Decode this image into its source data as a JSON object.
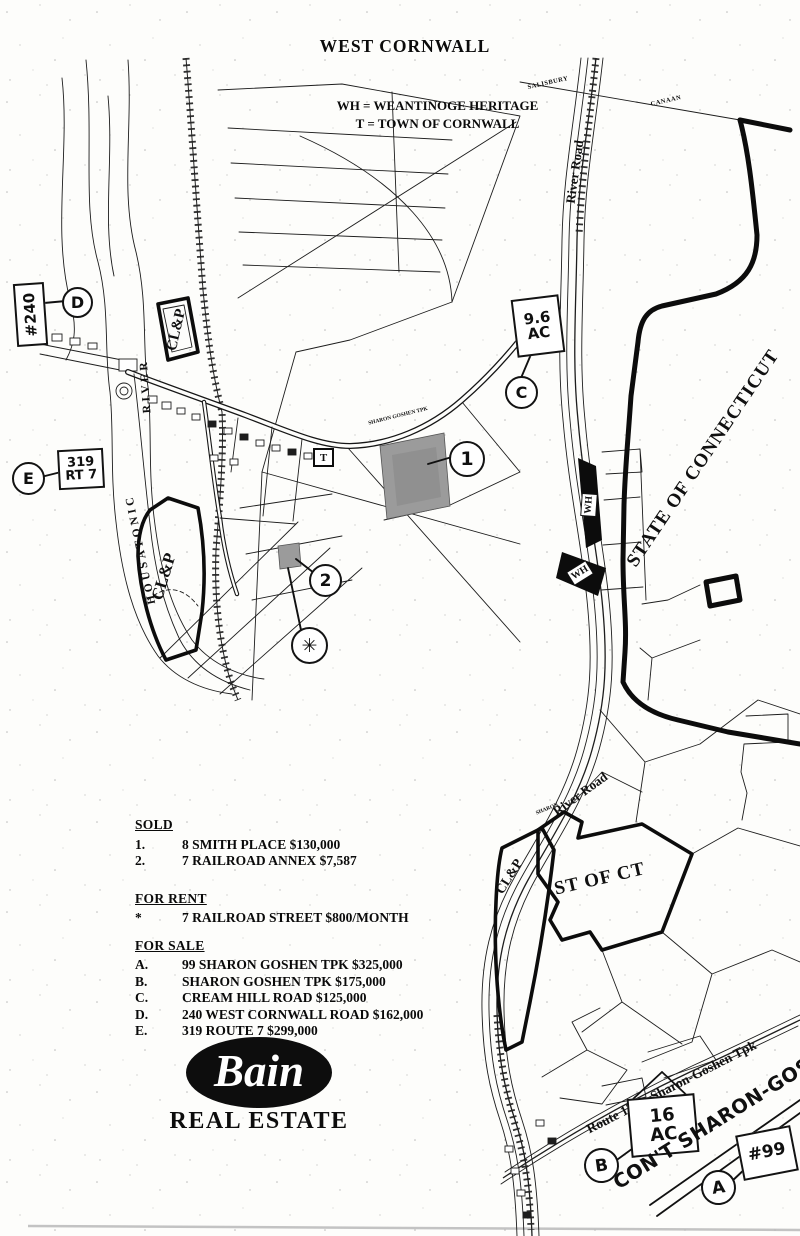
{
  "page": {
    "title": "WEST CORNWALL"
  },
  "legend": {
    "wh": "WH = WEANTINOGE HERITAGE",
    "t": "T = TOWN OF CORNWALL"
  },
  "map": {
    "towns": {
      "salisbury": "SALISBURY",
      "canaan": "CANAAN"
    },
    "roads": {
      "river_road_upper": "River Road",
      "river_road_lower": "River Road",
      "sharon_small": "SHARON",
      "route_120": "Route 120 – Sharon-Goshen Tpk",
      "sharon_goshen_tpk_small": "SHARON GOSHEN TPK"
    },
    "water": {
      "housatonic": "HOUSATONIC",
      "river": "RIVER"
    },
    "parcels": {
      "state_of_connecticut": "STATE OF CONNECTICUT",
      "st_of_ct": "ST OF CT",
      "clp_upper": "CL&P",
      "clp_lower": "CL&P",
      "clp_right": "CL&P",
      "wh_1": "WH",
      "wh_2": "WH",
      "t_box": "T"
    },
    "markers": {
      "d": {
        "letter": "D",
        "note": "#240"
      },
      "e": {
        "letter": "E",
        "note_line1": "319",
        "note_line2": "RT 7"
      },
      "c": {
        "letter": "C",
        "note_line1": "9.6",
        "note_line2": "AC"
      },
      "one": {
        "number": "1"
      },
      "two": {
        "number": "2"
      },
      "star": {
        "symbol": "✳"
      },
      "b": {
        "letter": "B",
        "note_line1": "16",
        "note_line2": "AC"
      },
      "a": {
        "letter": "A",
        "note": "#99"
      },
      "cont_note": "CON'T SHARON-GOSHEN"
    }
  },
  "listings": {
    "sold": {
      "heading": "SOLD",
      "items": [
        {
          "key": "1.",
          "text": "8 SMITH PLACE $130,000"
        },
        {
          "key": "2.",
          "text": "7 RAILROAD ANNEX $7,587"
        }
      ]
    },
    "for_rent": {
      "heading": "FOR RENT",
      "items": [
        {
          "key": "*",
          "text": "7 RAILROAD STREET $800/MONTH"
        }
      ]
    },
    "for_sale": {
      "heading": "FOR SALE",
      "items": [
        {
          "key": "A.",
          "text": "99 SHARON GOSHEN TPK $325,000"
        },
        {
          "key": "B.",
          "text": "SHARON GOSHEN TPK $175,000"
        },
        {
          "key": "C.",
          "text": "CREAM HILL ROAD $125,000"
        },
        {
          "key": "D.",
          "text": "240 WEST CORNWALL ROAD $162,000"
        },
        {
          "key": "E.",
          "text": "319 ROUTE 7 $299,000"
        }
      ]
    }
  },
  "logo": {
    "name": "Bain",
    "tagline": "REAL ESTATE"
  }
}
